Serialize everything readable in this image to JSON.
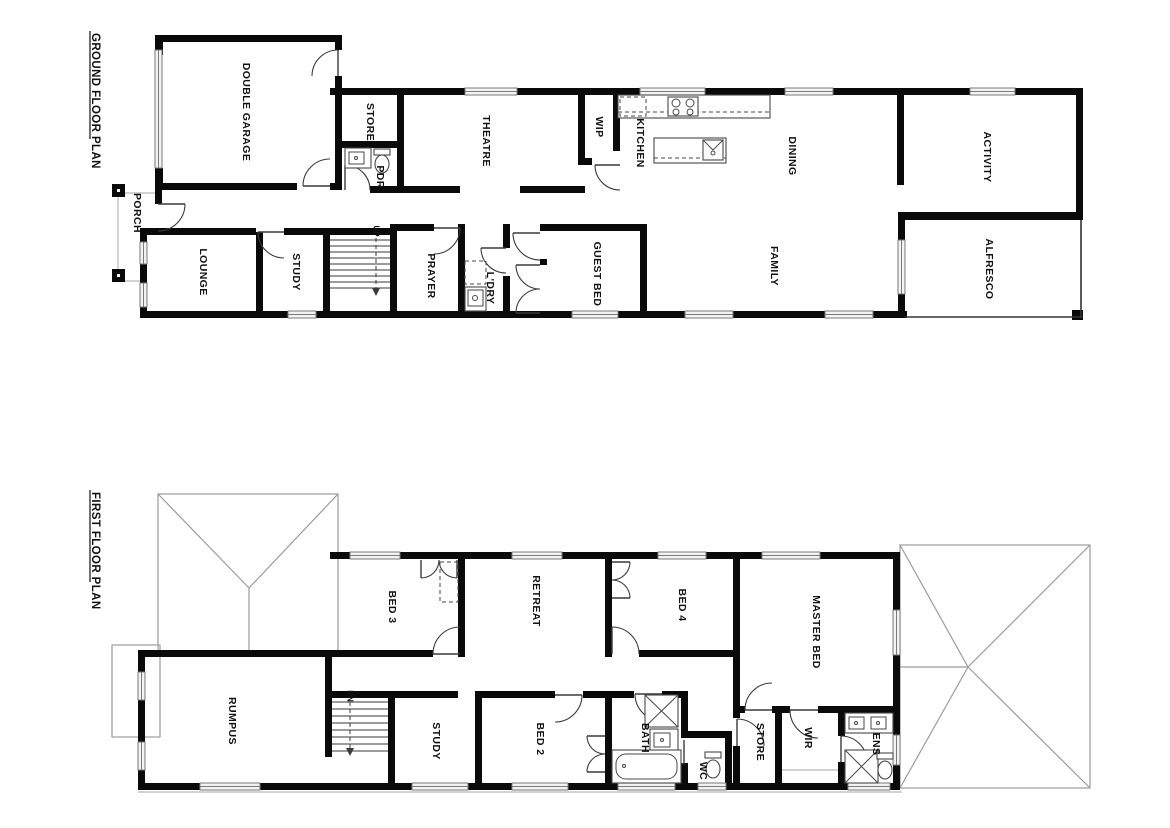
{
  "document": {
    "background": "#ffffff",
    "type_label": "architectural floor plan"
  },
  "colors": {
    "wall": "#0a0a0a",
    "door_line": "#3a3a3a",
    "window_line": "#7a7a7a",
    "roof_line": "#9b9b9b",
    "label_text": "#111111"
  },
  "ground_floor": {
    "title": "GROUND FLOOR PLAN",
    "stair_direction_label": "UP",
    "rooms": [
      {
        "name": "porch",
        "label": "PORCH"
      },
      {
        "name": "double-garage",
        "label": "DOUBLE GARAGE"
      },
      {
        "name": "store",
        "label": "STORE"
      },
      {
        "name": "powder-room",
        "label": "PDR"
      },
      {
        "name": "theatre",
        "label": "THEATRE"
      },
      {
        "name": "walk-in-pantry",
        "label": "WIP"
      },
      {
        "name": "kitchen",
        "label": "KITCHEN"
      },
      {
        "name": "dining",
        "label": "DINING"
      },
      {
        "name": "activity",
        "label": "ACTIVITY"
      },
      {
        "name": "family",
        "label": "FAMILY"
      },
      {
        "name": "alfresco",
        "label": "ALFRESCO"
      },
      {
        "name": "lounge",
        "label": "LOUNGE"
      },
      {
        "name": "study",
        "label": "STUDY"
      },
      {
        "name": "prayer",
        "label": "PRAYER"
      },
      {
        "name": "laundry",
        "label": "L'DRY"
      },
      {
        "name": "guest-bed",
        "label": "GUEST BED"
      }
    ]
  },
  "first_floor": {
    "title": "FIRST FLOOR PLAN",
    "stair_direction_label": "DN",
    "rooms": [
      {
        "name": "bed-3",
        "label": "BED 3"
      },
      {
        "name": "retreat",
        "label": "RETREAT"
      },
      {
        "name": "bed-4",
        "label": "BED 4"
      },
      {
        "name": "master-bed",
        "label": "MASTER BED"
      },
      {
        "name": "rumpus",
        "label": "RUMPUS"
      },
      {
        "name": "study",
        "label": "STUDY"
      },
      {
        "name": "bed-2",
        "label": "BED 2"
      },
      {
        "name": "bath",
        "label": "BATH"
      },
      {
        "name": "wc",
        "label": "WC"
      },
      {
        "name": "store",
        "label": "STORE"
      },
      {
        "name": "walk-in-robe",
        "label": "WIR"
      },
      {
        "name": "ensuite",
        "label": "ENS"
      }
    ]
  }
}
